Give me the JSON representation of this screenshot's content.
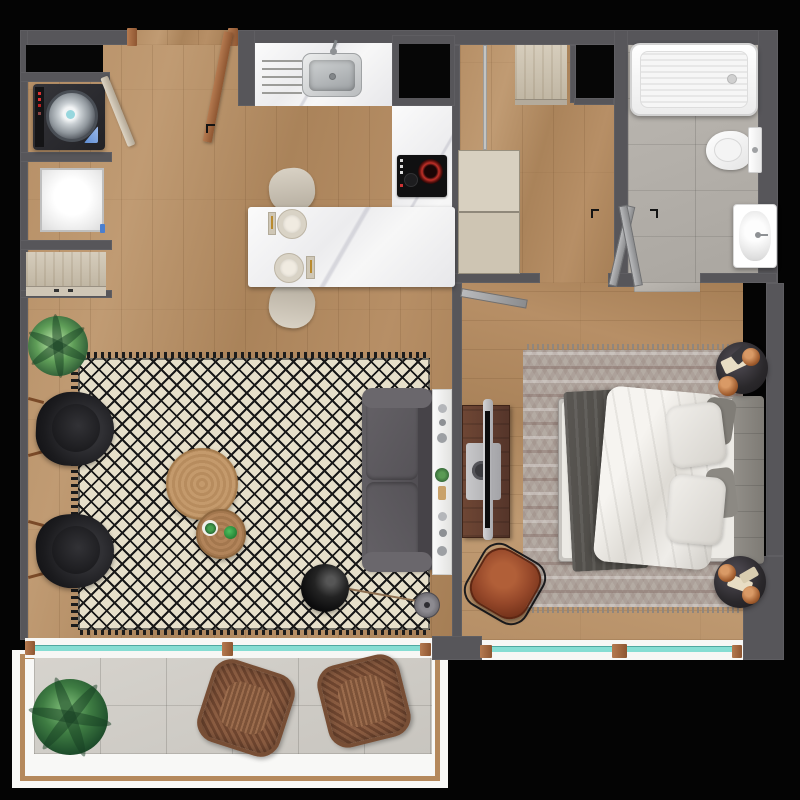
{
  "scene": {
    "type": "apartment-floor-plan",
    "style": "top-down 3d rendering",
    "canvas_px": {
      "width": 800,
      "height": 800
    }
  },
  "palette": {
    "bg": "#040404",
    "wall": "#57565a",
    "wood-light": "#bb9671",
    "wood-mid": "#ab8258",
    "wood-trim": "#b5895c",
    "door-brown": "#a9734f",
    "door-gray": "#a7a8aa",
    "marble": "#f2f2f2",
    "glass-teal": "#86ddd3",
    "tile-bath": "#b7b3ad",
    "tile-balcony": "#d3d0ca",
    "rug-cream": "#e6dfca",
    "rug-black": "#1a1a1a",
    "rug-bedroom": "#b4aba3",
    "sofa-gray": "#5b585d",
    "chair-black": "#1b1b1e",
    "leather-cognac": "#96482a",
    "copper": "#b9723f",
    "plant-green": "#3f7d43",
    "appliance-black": "#060606",
    "linen-white": "#eceae5",
    "blanket-charcoal": "#514e4a",
    "console-walnut": "#5f3c2d"
  },
  "rooms": [
    {
      "id": "entry-laundry",
      "contents": [
        "entry-door",
        "laundry-door",
        "washing-machine",
        "white-appliance",
        "storage-niche",
        "shoe-cabinet"
      ]
    },
    {
      "id": "kitchen",
      "contents": [
        "counter",
        "sink",
        "faucet",
        "drainboard",
        "refrigerator-recess",
        "induction-cooktop",
        "island-counter",
        "bar-stool",
        "bar-stool",
        "place-setting",
        "place-setting"
      ]
    },
    {
      "id": "hallway",
      "contents": [
        "wardrobe-top",
        "wardrobe-mid",
        "sliding-rail",
        "hall-door"
      ]
    },
    {
      "id": "bathroom",
      "contents": [
        "bathtub",
        "toilet",
        "washbasin",
        "double-doors"
      ]
    },
    {
      "id": "living-room",
      "contents": [
        "diamond-rug",
        "armchair",
        "armchair",
        "potted-plant",
        "coffee-table-large",
        "coffee-table-small",
        "sofa",
        "console-shelf",
        "arc-floor-lamp"
      ]
    },
    {
      "id": "bedroom",
      "contents": [
        "chevron-rug",
        "double-bed",
        "pillows",
        "blanket",
        "nightstand",
        "nightstand",
        "copper-lamps",
        "tv-console",
        "tv",
        "leather-chair"
      ]
    },
    {
      "id": "balcony",
      "contents": [
        "sliding-window",
        "bedroom-window",
        "potted-plant-large",
        "wicker-chair",
        "wicker-chair",
        "railing"
      ]
    }
  ]
}
